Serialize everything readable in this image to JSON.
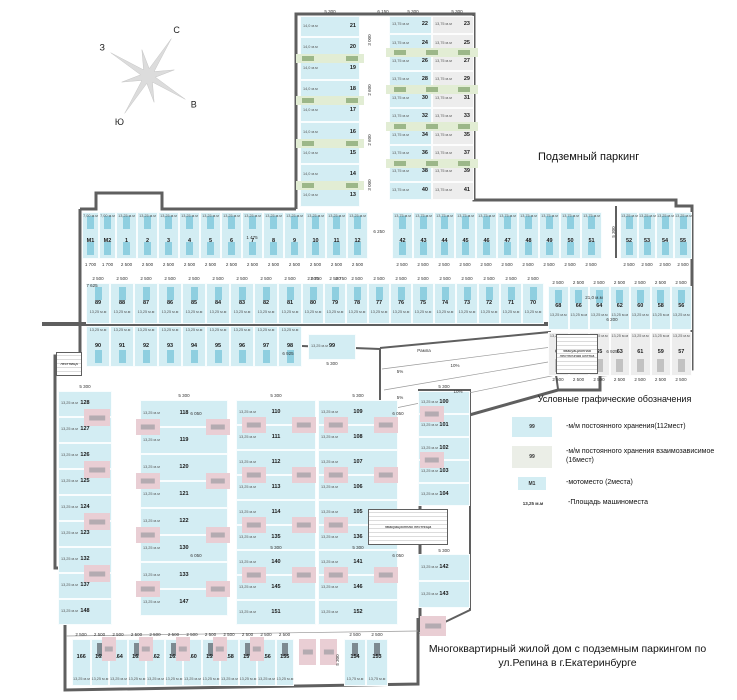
{
  "titles": {
    "plan_area_label": "Подземный паркинг",
    "project_title": "Многоквартирный жилой дом с подземным паркингом по ул.Репина в г.Екатеринбурге"
  },
  "compass": {
    "n": "С",
    "e": "В",
    "s": "Ю",
    "w": "З"
  },
  "legend": {
    "title": "Условные графические обозначения",
    "items": [
      {
        "swatch": "99",
        "label": "-м/м постоянного хранения(112мест)"
      },
      {
        "swatch": "99",
        "label": "-м/м постоянного хранения взаимозависимое (16мест)"
      },
      {
        "swatch": "М1",
        "label": "-мотоместо (2места)"
      },
      {
        "swatch": "13,25 м.м",
        "label": "-Площадь машиноместа"
      }
    ]
  },
  "stairs": {
    "lower": "эвакуационная лестница",
    "rampSide": "эвакуационная лестничная клетка",
    "left": "лестница"
  },
  "zones": {
    "stripTopLeft": {
      "area": "14,0 м.м",
      "stalls": [
        "21",
        "20",
        "19",
        "18",
        "17",
        "16",
        "15",
        "14",
        "13"
      ]
    },
    "stripTopRightA": {
      "area": "13,75 м.м",
      "stalls": [
        "22",
        "24",
        "26",
        "28",
        "30",
        "32",
        "34",
        "36",
        "38",
        "40"
      ]
    },
    "stripTopRightB": {
      "area": "13,75 м.м",
      "stalls": [
        "23",
        "25",
        "27",
        "29",
        "31",
        "33",
        "35",
        "37",
        "39",
        "41"
      ]
    },
    "bandUpperLeft": {
      "area": "13,25 м.м",
      "area_moto": "7,00 м.м",
      "dim": "2 500",
      "dim_moto": "1 700",
      "stalls": [
        "М1",
        "М2",
        "1",
        "2",
        "3",
        "4",
        "5",
        "6",
        "7",
        "8",
        "9",
        "10",
        "11",
        "12"
      ]
    },
    "bandUpperMid": {
      "area": "13,75 м.м",
      "dim": "2 500",
      "stalls": [
        "42",
        "43",
        "44",
        "45",
        "46",
        "47",
        "48",
        "49",
        "50",
        "51"
      ]
    },
    "bandUpperRight": {
      "area": "13,25 м.м",
      "dim": "2 500",
      "stalls": [
        "52",
        "53",
        "54",
        "55"
      ]
    },
    "rowMidUpperLeft": {
      "area": "13,25 м.м",
      "dim": "2 500",
      "stalls": [
        "89",
        "88",
        "87",
        "86",
        "85",
        "84",
        "83",
        "82",
        "81"
      ]
    },
    "rowMidUpperRight": {
      "area": "13,25 м.м",
      "dim": "2 500",
      "stalls": [
        "80",
        "79",
        "78",
        "77",
        "76",
        "75",
        "74",
        "73",
        "72",
        "71",
        "70"
      ]
    },
    "rowMidLower": {
      "area": "13,25 м.м",
      "stalls": [
        "90",
        "91",
        "92",
        "93",
        "94",
        "95",
        "96",
        "97",
        "98"
      ]
    },
    "stall99": {
      "num": "99",
      "area": "13,25 м.м",
      "dim": "5 300"
    },
    "blockRightTop": {
      "area": "13,25 м.м",
      "dim": "2 500",
      "stalls": [
        "68",
        "66",
        "64",
        "62",
        "60",
        "58",
        "56"
      ]
    },
    "blockRightBottom": {
      "area": "13,25 м.м",
      "dim": "2 500",
      "stalls": [
        "69",
        "67",
        "65",
        "63",
        "61",
        "59",
        "57"
      ]
    },
    "colA": {
      "area": "13,25 м.м",
      "stalls": [
        "128",
        "127",
        "126",
        "125",
        "124",
        "123",
        "132",
        "137",
        "148"
      ]
    },
    "colB": {
      "area": "13,25 м.м",
      "stalls": [
        "118",
        "119",
        "120",
        "121",
        "122",
        "130",
        "133",
        "147"
      ]
    },
    "colC1": {
      "area": "13,25 м.м",
      "stalls": [
        "110",
        "111",
        "112",
        "113",
        "114",
        "135",
        "140",
        "145",
        "151"
      ]
    },
    "colC2": {
      "area": "13,25 м.м",
      "stalls": [
        "109",
        "108",
        "107",
        "106",
        "105",
        "136",
        "141",
        "146",
        "152"
      ]
    },
    "colD1": {
      "area": "13,25 м.м",
      "stalls": [
        "100",
        "101",
        "102",
        "103",
        "104"
      ]
    },
    "colD2": {
      "area": "13,25 м.м",
      "stalls": [
        "142",
        "143"
      ]
    },
    "bottomRow": {
      "area": "13,25 м.м",
      "dim": "2 500",
      "stalls": [
        "166",
        "165",
        "164",
        "163",
        "162",
        "161",
        "160",
        "159",
        "158",
        "157",
        "156",
        "155"
      ]
    },
    "bottomRowRight": {
      "area": "13,75 м.м",
      "dim": "2 500",
      "stalls": [
        "154",
        "153"
      ]
    }
  },
  "annotations": [
    {
      "t": "5 300",
      "x": 330,
      "y": 10
    },
    {
      "t": "6 150",
      "x": 383,
      "y": 10
    },
    {
      "t": "5 300",
      "x": 413,
      "y": 10
    },
    {
      "t": "5 300",
      "x": 457,
      "y": 10
    },
    {
      "t": "3 000",
      "x": 370,
      "y": 40,
      "r": 1
    },
    {
      "t": "2 600",
      "x": 370,
      "y": 90,
      "r": 1
    },
    {
      "t": "2 600",
      "x": 370,
      "y": 140,
      "r": 1
    },
    {
      "t": "3 000",
      "x": 370,
      "y": 185,
      "r": 1
    },
    {
      "t": "7 625",
      "x": 92,
      "y": 284
    },
    {
      "t": "2 750",
      "x": 316,
      "y": 277
    },
    {
      "t": "2 750",
      "x": 341,
      "y": 277
    },
    {
      "t": "6 250",
      "x": 379,
      "y": 230
    },
    {
      "t": "1 475",
      "x": 252,
      "y": 236
    },
    {
      "t": "5 300",
      "x": 614,
      "y": 232,
      "r": 1
    },
    {
      "t": "21,0 м.м",
      "x": 594,
      "y": 296
    },
    {
      "t": "6 200",
      "x": 612,
      "y": 318
    },
    {
      "t": "6 925",
      "x": 612,
      "y": 350
    },
    {
      "t": "6 925",
      "x": 288,
      "y": 352
    },
    {
      "t": "5 300",
      "x": 332,
      "y": 362
    },
    {
      "t": "Рампа",
      "x": 424,
      "y": 349
    },
    {
      "t": "10%",
      "x": 455,
      "y": 364
    },
    {
      "t": "5%",
      "x": 400,
      "y": 370
    },
    {
      "t": "10%",
      "x": 458,
      "y": 390
    },
    {
      "t": "5%",
      "x": 400,
      "y": 396
    },
    {
      "t": "6 050",
      "x": 196,
      "y": 412
    },
    {
      "t": "6 050",
      "x": 398,
      "y": 412
    },
    {
      "t": "6 050",
      "x": 196,
      "y": 554
    },
    {
      "t": "6 050",
      "x": 398,
      "y": 554
    },
    {
      "t": "5 300",
      "x": 85,
      "y": 385
    },
    {
      "t": "5 300",
      "x": 184,
      "y": 394
    },
    {
      "t": "5 300",
      "x": 276,
      "y": 394
    },
    {
      "t": "5 300",
      "x": 358,
      "y": 394
    },
    {
      "t": "5 300",
      "x": 444,
      "y": 385
    },
    {
      "t": "5 300",
      "x": 276,
      "y": 546
    },
    {
      "t": "5 300",
      "x": 358,
      "y": 546
    },
    {
      "t": "5 300",
      "x": 444,
      "y": 549
    },
    {
      "t": "5 300",
      "x": 338,
      "y": 660,
      "r": 1
    }
  ]
}
